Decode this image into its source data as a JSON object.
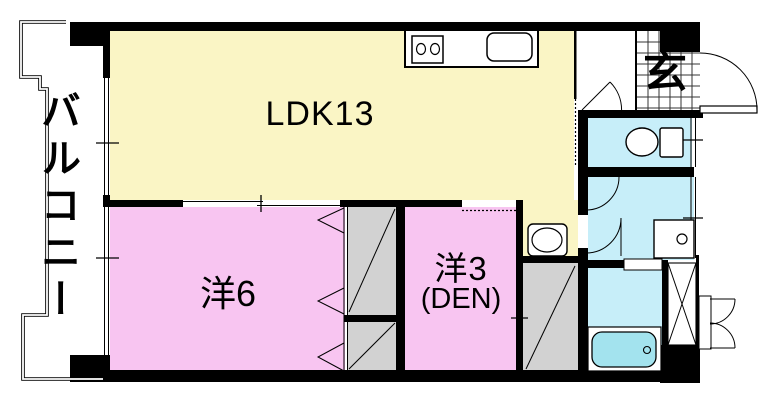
{
  "floorplan": {
    "kind": "apartment-floor-plan",
    "rooms": {
      "balcony": {
        "label": "バルコニー"
      },
      "ldk": {
        "label": "LDK13"
      },
      "western_room_6": {
        "label": "洋6"
      },
      "western_room_3": {
        "label": "洋3",
        "sublabel": "(DEN)"
      },
      "entrance": {
        "label": "玄"
      }
    },
    "fixtures": [
      "kitchen-stove-icon",
      "kitchen-sink-icon",
      "toilet-icon",
      "washbasin-icon",
      "washing-machine-icon",
      "bathtub-icon",
      "pipe-shaft-icon",
      "entrance-tile-icon"
    ],
    "colors": {
      "wall": "#000000",
      "ldk_fill": "#FAF5C5",
      "bedroom_fill": "#F8C5F1",
      "wet_area_fill": "#C7EEF9",
      "bathtub_fill": "#A3E3EE",
      "closet_fill": "#D2D2D2",
      "background": "#FFFFFF"
    }
  }
}
